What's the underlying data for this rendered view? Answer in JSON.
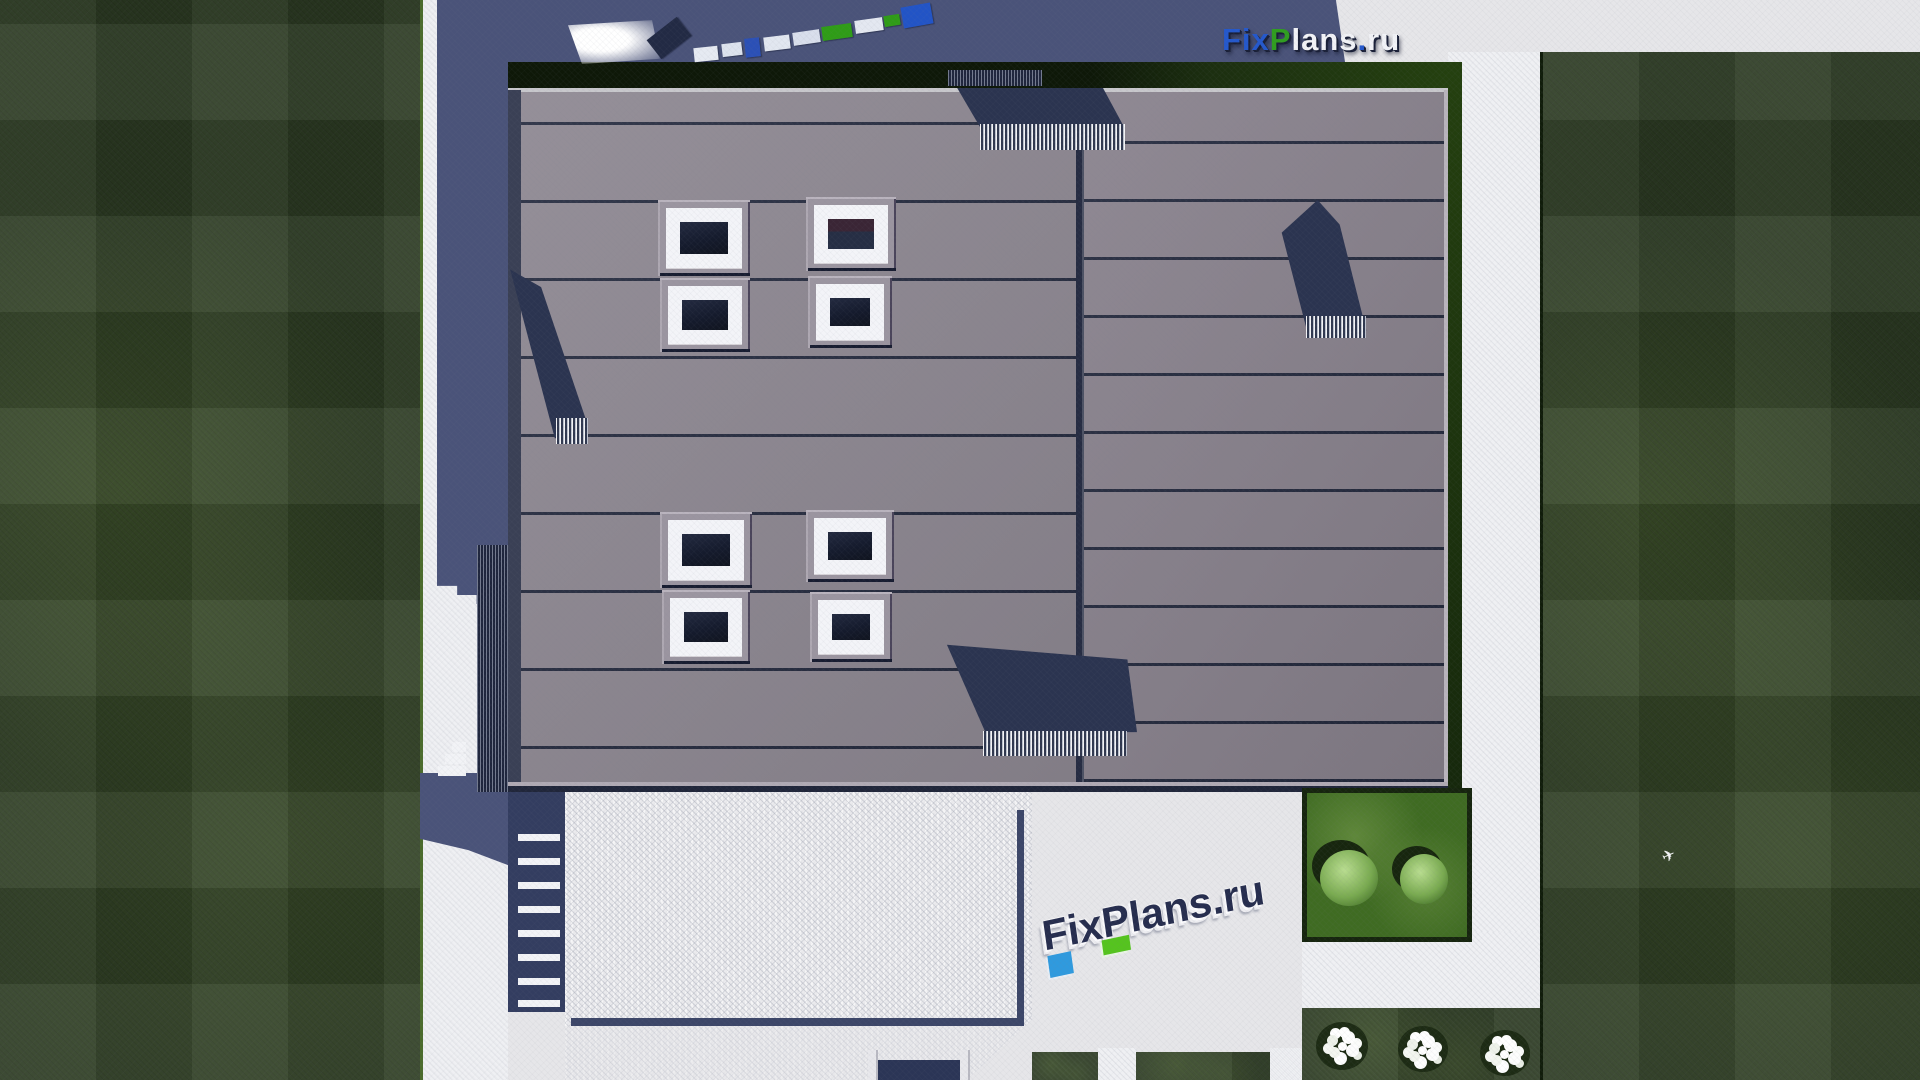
{
  "title": "FixPlans.ru — aerial roof plan render of a flat-roof house",
  "branding": {
    "logo": {
      "full": "FixPlans.ru",
      "fix": "Fix",
      "p": "P",
      "lans": "lans",
      "dot": ".",
      "ru": "ru",
      "fix_color": "#2458cc",
      "p_color": "#2f9e1f",
      "light_color": "#f2f3f7"
    },
    "watermark": {
      "text": "FixPlans.ru"
    }
  },
  "palette": {
    "lawn_dark_green": "#2c3b22",
    "garden_bed_green": "#3f6b22",
    "hedge_green": "#16240e",
    "roof_left_panels": "#8d8791",
    "roof_right_panels": "#8a838e",
    "panel_seam_navy": "#242a3e",
    "cast_shadow_navy": "#4a5379",
    "roof_shadow_navy": "#2b3450",
    "pavement_light": "#e6e6e9",
    "terrace_concrete": "#ebebee",
    "skylight_glass": "#151b2d",
    "skylight_frame": "#f3f4f8",
    "bush_green": "#79aa50",
    "flower_white": "#ffffff"
  },
  "scene": {
    "view": "top-down aerial render",
    "counts": {
      "skylights": 8,
      "roof_vents": 4,
      "bushes": 2,
      "flower_clusters": 3,
      "stair_steps": 8
    }
  }
}
